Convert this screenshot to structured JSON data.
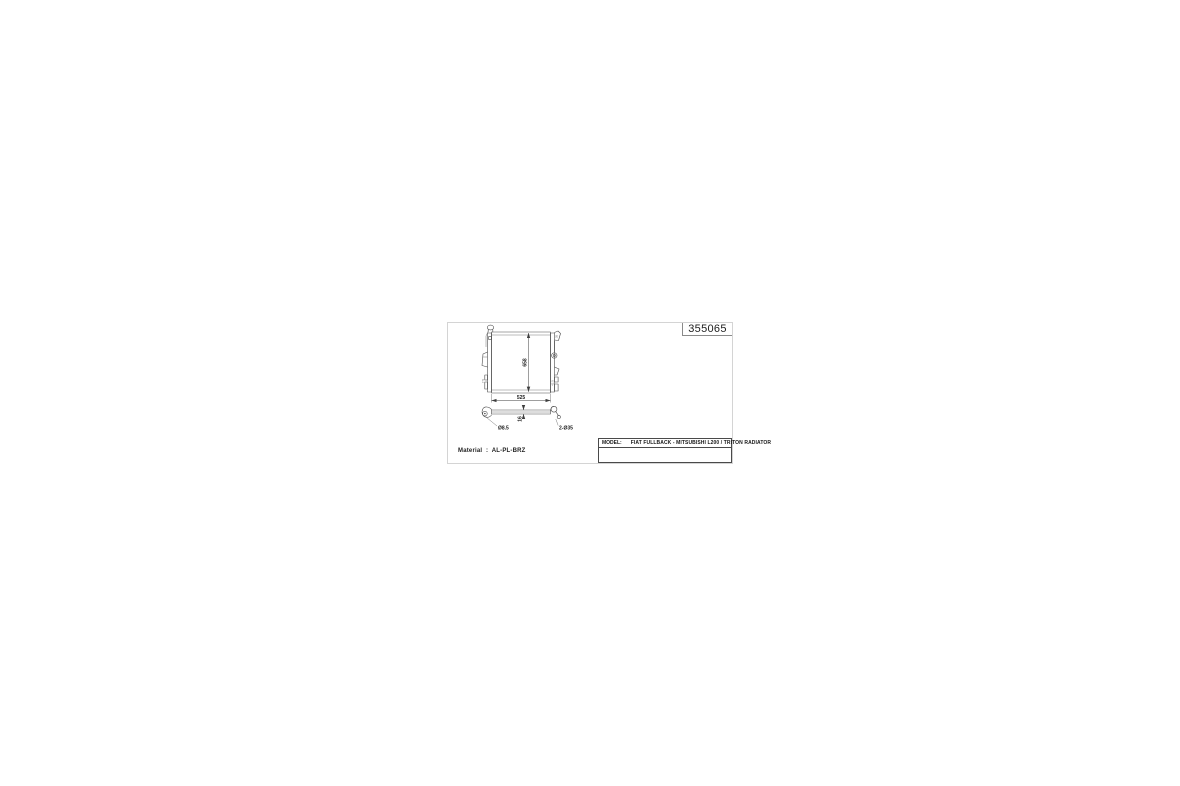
{
  "sheet": {
    "part_number": "355065",
    "material_note": "Material  :  AL-PL-BRZ",
    "title_block": {
      "model_label": "MODEL:",
      "model_value": "FIAT FULLBACK - MITSUBISHI L200 / TRITON RADIATOR"
    },
    "dimensions": {
      "core_height": "658",
      "core_width": "525",
      "core_thickness": "16",
      "drain_hole": "Ø8.5",
      "pipe_spec": "2-Ø35",
      "bracket_note_top_right": "35",
      "bracket_note_bottom_right": "42.5",
      "bracket_note_bottom_left": "7.5"
    },
    "colors": {
      "line": "#4a4a4a",
      "text": "#1c1c1c",
      "sheet_border": "#d4d4d4"
    }
  }
}
